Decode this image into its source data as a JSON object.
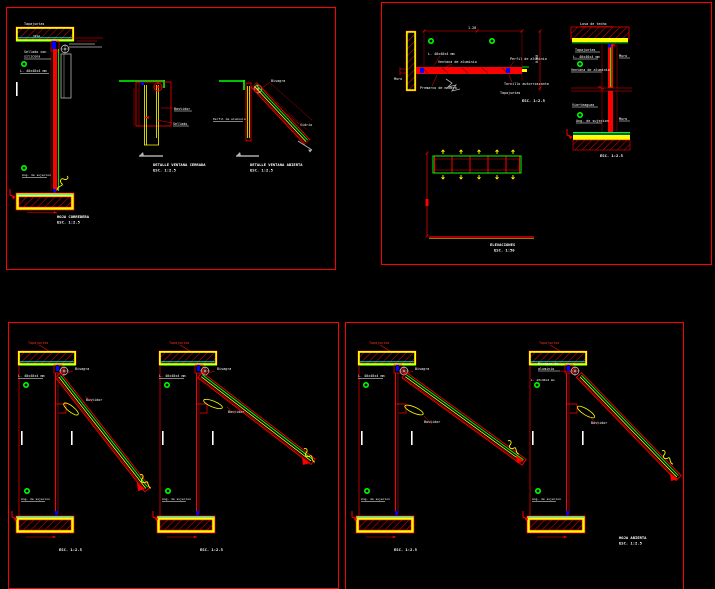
{
  "canvas": {
    "bg": "#000000",
    "border_color": "#ff0000"
  },
  "palette": {
    "red": "#ff0000",
    "yellow": "#ffff00",
    "green": "#00ff00",
    "cyan": "#00ffff",
    "blue": "#0000ff",
    "gray": "#b4b4b4",
    "white": "#ffffff"
  },
  "p1": {
    "d1": {
      "top_label": "Tapajuntas",
      "beam_label": "VIGA",
      "seal_label_1": "Sellado con",
      "seal_label_2": "silicona",
      "angle_label": "L. 40x40x4 mm",
      "anchor_label": "Ang. de sujecion",
      "title": "HOJA CORREDERA",
      "scale": "ESC. 1:2.5"
    },
    "d2": {
      "label_frame": "Bastidor",
      "label_seal": "Sellado",
      "title": "DETALLE VENTANA CERRADA",
      "scale": "ESC. 1:2.5"
    },
    "d3": {
      "label_hinge": "Bisagra",
      "label_profile": "Perfil de aluminio",
      "label_glass": "Vidrio",
      "title": "DETALLE VENTANA ABIERTA",
      "scale": "ESC. 1:2.5"
    }
  },
  "p2": {
    "plan": {
      "dim_top": "1.20",
      "dim_right": "0.60",
      "label_angle": "L. 40x40x4 mm",
      "label_window": "Ventana de aluminio",
      "label_profile": "Perfil de aluminio",
      "label_wall": "Muro",
      "label_premarco": "Premarco de madera",
      "label_screw": "Tornillo autorroscante",
      "label_cover": "Tapajuntas",
      "scale": "ESC. 1:2.5"
    },
    "section": {
      "top_label": "Losa de techo",
      "label_cover": "Tapajuntas",
      "label_angle": "L. 40x40x4 mm",
      "label_window": "Ventana de aluminio",
      "label_wall_upper": "Muro",
      "label_sill": "Vierteaguas",
      "label_anchor": "Ang. de sujecion",
      "label_wall_lower": "Muro",
      "scale": "ESC. 1:2.5"
    },
    "elevation": {
      "title": "ELEVACIONES",
      "scale": "ESC. 1:50"
    }
  },
  "p3": {
    "d1": {
      "top_label": "Tapajuntas",
      "label_hinge": "Bisagra",
      "label_angle": "L. 40x40x4 mm",
      "label_frame": "Bastidor",
      "label_anchor": "Ang. de sujecion",
      "scale": "ESC. 1:2.5"
    },
    "d2": {
      "top_label": "Tapajuntas",
      "label_hinge": "Bisagra",
      "label_angle": "L. 40x40x4 mm",
      "label_frame": "Bastidor",
      "label_anchor": "Ang. de sujecion",
      "scale": "ESC. 1:2.5"
    }
  },
  "p4": {
    "d1": {
      "top_label": "Tapajuntas",
      "label_hinge": "Bisagra",
      "label_angle": "L. 40x40x4 mm",
      "label_frame": "Bastidor",
      "label_anchor": "Ang. de sujecion",
      "scale": "ESC. 1:2.5"
    },
    "d2": {
      "top_label": "Tapajuntas",
      "label_hinge_1": "Bisagra de",
      "label_hinge_2": "aluminio",
      "label_angle": "L. 40x40x4 mm",
      "label_frame": "Bastidor",
      "label_anchor": "Ang. de sujecion",
      "title": "HOJA ABIERTA",
      "scale": "ESC. 1:2.5"
    }
  }
}
